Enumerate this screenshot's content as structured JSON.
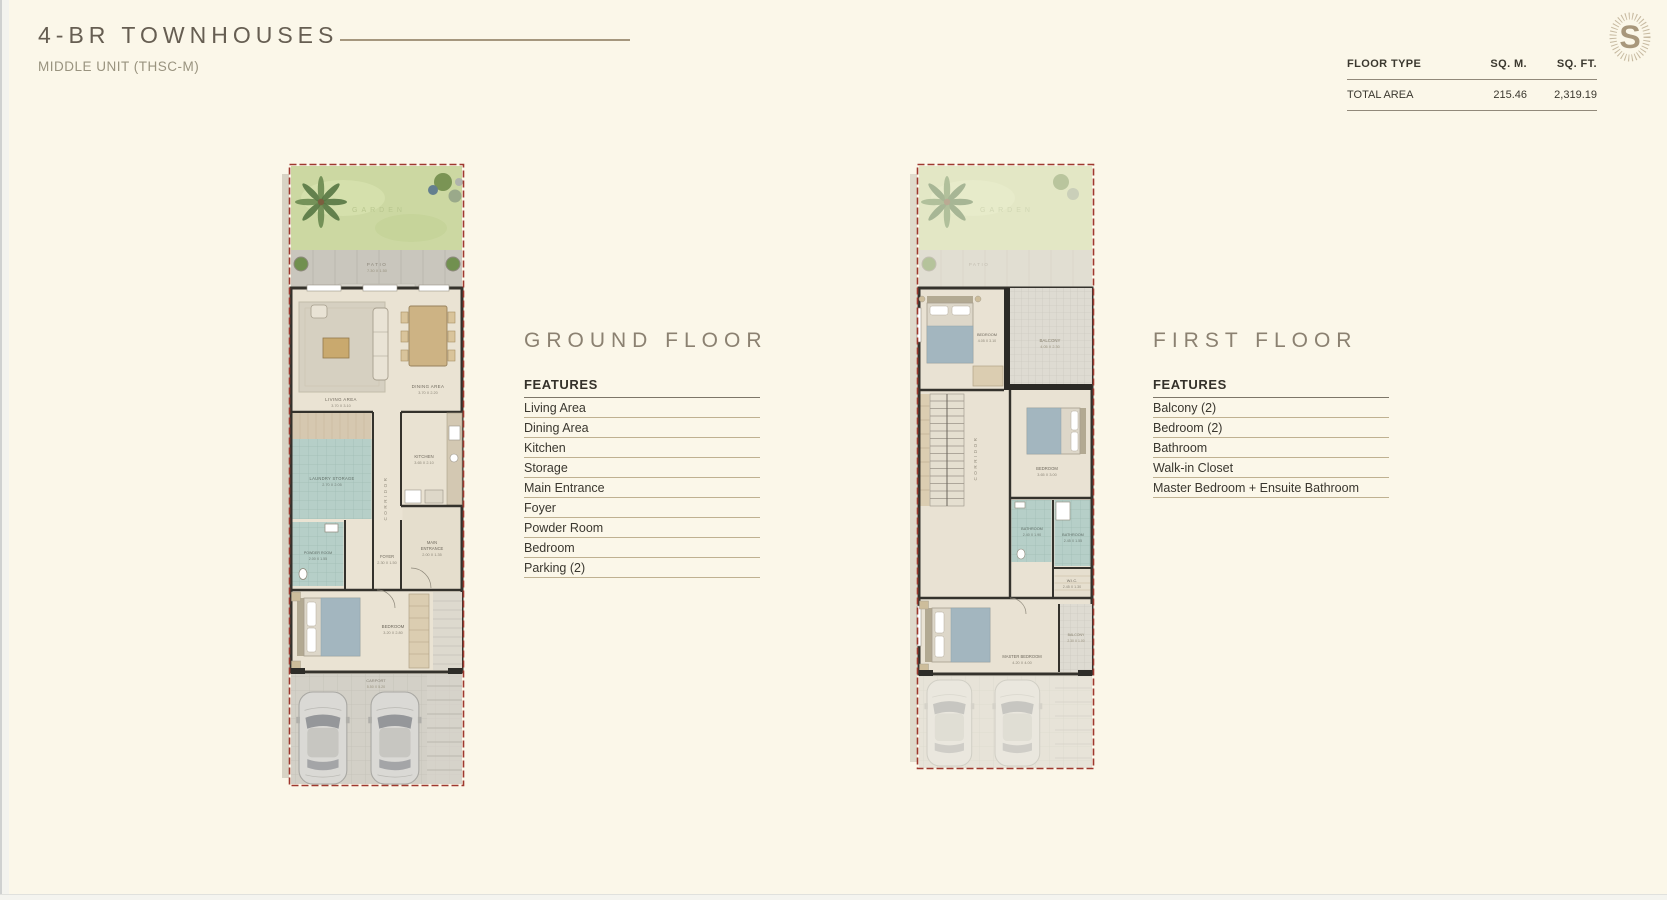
{
  "header": {
    "title": "4-BR TOWNHOUSES",
    "subtitle": "MIDDLE UNIT (THSC-M)"
  },
  "area_table": {
    "col_floor_type": "FLOOR TYPE",
    "col_sqm": "SQ. M.",
    "col_sqft": "SQ. FT.",
    "row": {
      "floor_type": "TOTAL AREA",
      "sqm": "215.46",
      "sqft": "2,319.19"
    }
  },
  "ground_floor": {
    "heading": "GROUND FLOOR",
    "features_label": "FEATURES",
    "features": [
      "Living Area",
      "Dining Area",
      "Kitchen",
      "Storage",
      "Main Entrance",
      "Foyer",
      "Powder Room",
      "Bedroom",
      "Parking (2)"
    ]
  },
  "first_floor": {
    "heading": "FIRST FLOOR",
    "features_label": "FEATURES",
    "features": [
      "Balcony (2)",
      "Bedroom (2)",
      "Bathroom",
      "Walk-in Closet",
      "Master Bedroom + Ensuite Bathroom"
    ]
  },
  "ground_plan": {
    "garden": "GARDEN",
    "patio": "PATIO",
    "patio_dims": "7.30 X 1.50",
    "living": "LIVING AREA",
    "living_dims": "3.70 X 3.10",
    "dining": "DINING AREA",
    "dining_dims": "3.70 X 2.20",
    "laundry": "LAUNDRY  STORAGE",
    "laundry_dims": "2.70 X 2.05",
    "corridor": "CORRIDOR",
    "kitchen": "KITCHEN",
    "kitchen_dims": "3.65 X 2.10",
    "main_entrance_1": "MAIN",
    "main_entrance_2": "ENTRANCE",
    "main_entrance_dims": "2.00 X 1.35",
    "foyer": "FOYER",
    "foyer_dims": "2.30 X 1.50",
    "powder": "POWDER ROOM",
    "powder_dims": "2.00 X 1.55",
    "bedroom": "BEDROOM",
    "bedroom_dims": "3.20 X 2.80",
    "carport": "CARPORT",
    "carport_dims": "5.50 X 5.20"
  },
  "first_plan": {
    "garden": "GARDEN",
    "patio": "PATIO",
    "bedroom1": "BEDROOM",
    "bedroom1_dims": "4.05 X 3.10",
    "balcony1": "BALCONY",
    "balcony1_dims": "4.05 X 2.30",
    "corridor": "CORRIDOR",
    "bedroom2": "BEDROOM",
    "bedroom2_dims": "3.65 X 3.00",
    "bathroom1": "BATHROOM",
    "bathroom1_dims": "2.40 X 1.90",
    "bathroom2": "BATHROOM",
    "bathroom2_dims": "2.45 X 1.55",
    "wic": "W.I.C.",
    "wic_dims": "2.45 X 1.30",
    "master": "MASTER BEDROOM",
    "master_dims": "4.20 X 4.00",
    "balcony2": "BALCONY",
    "balcony2_dims": "2.30 X 1.00"
  },
  "colors": {
    "background": "#fbf7e9",
    "accent_red_boundary": "#9e382e",
    "garden_green": "#ccd8a2",
    "teal_room": "#b6cfc8",
    "logo_gold": "#a8977b"
  }
}
